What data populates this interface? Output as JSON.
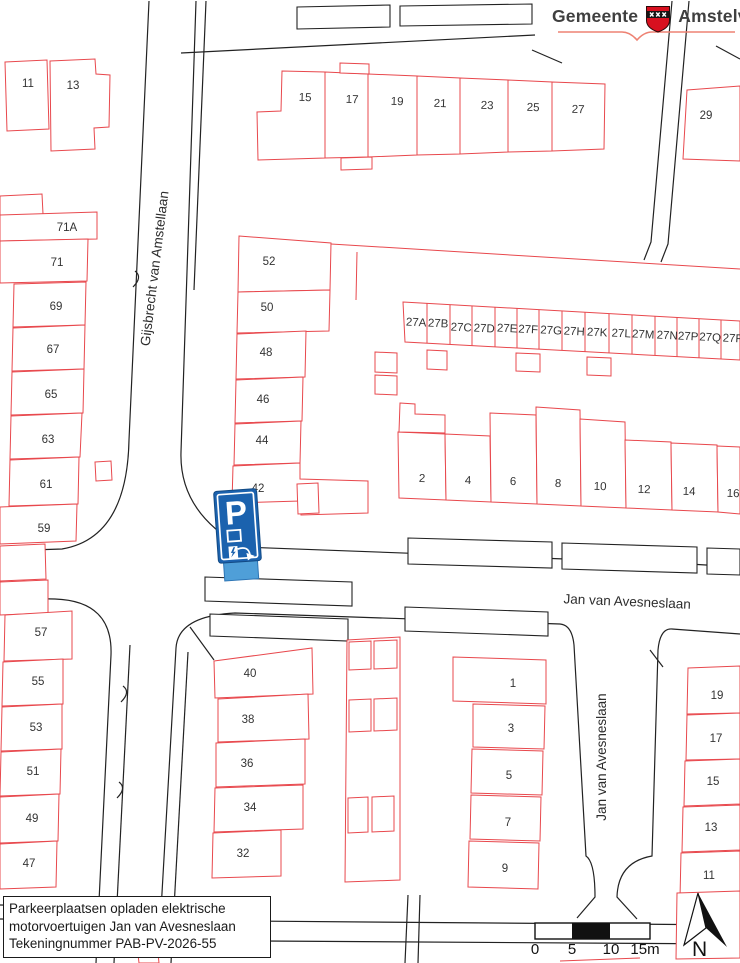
{
  "logo": {
    "left": "Gemeente",
    "right": "Amstelveen"
  },
  "title_block": {
    "lines": [
      "Parkeerplaatsen opladen elektrische",
      "motorvoertuigen Jan van Avesneslaan",
      "Tekeningnummer PAB-PV-2026-55"
    ]
  },
  "scale_bar": {
    "labels": [
      "0",
      "5",
      "10",
      "15m"
    ],
    "label_x": [
      535,
      572,
      611,
      645
    ]
  },
  "north_label": "N",
  "streets": [
    {
      "t": "Gijsbrecht van Amstellaan",
      "x": 159,
      "y": 269,
      "r": -83
    },
    {
      "t": "Jan van Avesneslaan",
      "x": 627,
      "y": 606,
      "r": 2.5
    },
    {
      "t": "Jan van Avesneslaan",
      "x": 606,
      "y": 757,
      "r": -90
    }
  ],
  "houses": [
    {
      "t": "11",
      "x": 28,
      "y": 87
    },
    {
      "t": "13",
      "x": 73,
      "y": 89
    },
    {
      "t": "15",
      "x": 305,
      "y": 101,
      "r": 2
    },
    {
      "t": "17",
      "x": 352,
      "y": 103,
      "r": 2
    },
    {
      "t": "19",
      "x": 397,
      "y": 105,
      "r": 2
    },
    {
      "t": "21",
      "x": 440,
      "y": 107,
      "r": 2
    },
    {
      "t": "23",
      "x": 487,
      "y": 109,
      "r": 2
    },
    {
      "t": "25",
      "x": 533,
      "y": 111,
      "r": 2
    },
    {
      "t": "27",
      "x": 578,
      "y": 113,
      "r": 2
    },
    {
      "t": "29",
      "x": 706,
      "y": 119
    },
    {
      "t": "71A",
      "x": 67,
      "y": 231
    },
    {
      "t": "71",
      "x": 57,
      "y": 266
    },
    {
      "t": "69",
      "x": 56,
      "y": 310
    },
    {
      "t": "67",
      "x": 53,
      "y": 353
    },
    {
      "t": "65",
      "x": 51,
      "y": 398
    },
    {
      "t": "63",
      "x": 48,
      "y": 443
    },
    {
      "t": "61",
      "x": 46,
      "y": 488
    },
    {
      "t": "59",
      "x": 44,
      "y": 532
    },
    {
      "t": "57",
      "x": 41,
      "y": 636
    },
    {
      "t": "55",
      "x": 38,
      "y": 685
    },
    {
      "t": "53",
      "x": 36,
      "y": 731
    },
    {
      "t": "51",
      "x": 33,
      "y": 775
    },
    {
      "t": "49",
      "x": 32,
      "y": 822
    },
    {
      "t": "47",
      "x": 29,
      "y": 867
    },
    {
      "t": "52",
      "x": 269,
      "y": 265
    },
    {
      "t": "50",
      "x": 267,
      "y": 311
    },
    {
      "t": "48",
      "x": 266,
      "y": 356
    },
    {
      "t": "46",
      "x": 263,
      "y": 403
    },
    {
      "t": "44",
      "x": 262,
      "y": 444
    },
    {
      "t": "42",
      "x": 258,
      "y": 492
    },
    {
      "t": "27A",
      "x": 416,
      "y": 326,
      "r": 3
    },
    {
      "t": "27B",
      "x": 438,
      "y": 327,
      "r": 3
    },
    {
      "t": "27C",
      "x": 461,
      "y": 331,
      "r": 3
    },
    {
      "t": "27D",
      "x": 484,
      "y": 332,
      "r": 3
    },
    {
      "t": "27E",
      "x": 507,
      "y": 332,
      "r": 3
    },
    {
      "t": "27F",
      "x": 528,
      "y": 333,
      "r": 3
    },
    {
      "t": "27G",
      "x": 551,
      "y": 334,
      "r": 3
    },
    {
      "t": "27H",
      "x": 574,
      "y": 335,
      "r": 3
    },
    {
      "t": "27K",
      "x": 597,
      "y": 336,
      "r": 3
    },
    {
      "t": "27L",
      "x": 621,
      "y": 337,
      "r": 3
    },
    {
      "t": "27M",
      "x": 643,
      "y": 338,
      "r": 3
    },
    {
      "t": "27N",
      "x": 667,
      "y": 339,
      "r": 3
    },
    {
      "t": "27P",
      "x": 688,
      "y": 340,
      "r": 3
    },
    {
      "t": "27Q",
      "x": 710,
      "y": 341,
      "r": 3
    },
    {
      "t": "27R",
      "x": 733,
      "y": 342,
      "r": 3
    },
    {
      "t": "2",
      "x": 422,
      "y": 482,
      "r": 2
    },
    {
      "t": "4",
      "x": 468,
      "y": 484,
      "r": 2
    },
    {
      "t": "6",
      "x": 513,
      "y": 485,
      "r": 2
    },
    {
      "t": "8",
      "x": 558,
      "y": 487,
      "r": 2
    },
    {
      "t": "10",
      "x": 600,
      "y": 490,
      "r": 2
    },
    {
      "t": "12",
      "x": 644,
      "y": 493,
      "r": 2
    },
    {
      "t": "14",
      "x": 689,
      "y": 495,
      "r": 2
    },
    {
      "t": "16",
      "x": 733,
      "y": 497,
      "r": 2
    },
    {
      "t": "40",
      "x": 250,
      "y": 677
    },
    {
      "t": "38",
      "x": 248,
      "y": 723
    },
    {
      "t": "36",
      "x": 247,
      "y": 767
    },
    {
      "t": "34",
      "x": 250,
      "y": 811
    },
    {
      "t": "32",
      "x": 243,
      "y": 857
    },
    {
      "t": "1",
      "x": 513,
      "y": 687
    },
    {
      "t": "3",
      "x": 511,
      "y": 732
    },
    {
      "t": "5",
      "x": 509,
      "y": 779
    },
    {
      "t": "7",
      "x": 508,
      "y": 826
    },
    {
      "t": "9",
      "x": 505,
      "y": 872
    },
    {
      "t": "19",
      "x": 717,
      "y": 699
    },
    {
      "t": "17",
      "x": 716,
      "y": 742
    },
    {
      "t": "15",
      "x": 713,
      "y": 785
    },
    {
      "t": "13",
      "x": 711,
      "y": 831
    },
    {
      "t": "11",
      "x": 709,
      "y": 879
    }
  ],
  "parking_sign": {
    "letter": "P"
  },
  "colors": {
    "building_outline": "#e8484d",
    "road_line": "#222222",
    "label_text": "#333333",
    "street_text": "#2c2c2c",
    "sign_blue": "#1b62ae",
    "sign_base_blue": "#4f9fd8",
    "crest_red": "#d8101f",
    "logo_underline": "#ee8273"
  }
}
